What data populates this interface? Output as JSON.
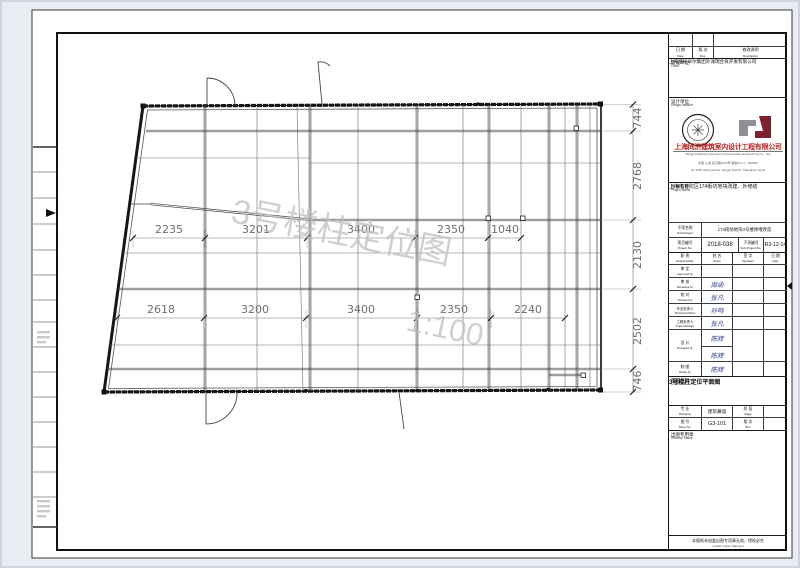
{
  "watermark": {
    "title": "3号楼柱定位图",
    "scale": "1:100"
  },
  "plan": {
    "dims_mid": [
      "2235",
      "3201",
      "3400",
      "2350",
      "1040"
    ],
    "dims_bottom": [
      "2618",
      "3200",
      "3400",
      "2350",
      "2240"
    ],
    "dims_right": [
      "744",
      "2768",
      "2130",
      "2502",
      "746"
    ]
  },
  "titleblock": {
    "revision": {
      "date_cn": "日 期",
      "date_en": "Date",
      "rev_cn": "版 次",
      "rev_en": "Rev.",
      "desc_cn": "修改说明",
      "desc_en": "Description"
    },
    "client": {
      "label_cn": "建设单位",
      "label_en": "Client",
      "name": "上海临光卓尔集团外滩瑞合资开发有限公司"
    },
    "design_institute": {
      "label_cn": "设计单位",
      "label_en": "Design Institute",
      "company_cn": "上海同济建筑室内设计工程有限公司",
      "company_en": "Tongji Architectural Design and Decoration Engineering Co., Ltd.",
      "address": "中国 上海 四平路1230号  邮编(P.C.)：200092",
      "address2": "No.1230 Siping Road, Yangpu District, Shanghai, China"
    },
    "project": {
      "label_cn": "项目名称",
      "label_en": "Project Name",
      "name": "上海市普陀区174街坊地块改建、外修缮"
    },
    "sub_project": {
      "label_cn": "子项名称",
      "label_en": "Sub-Project",
      "name": "174街坊地块3号楼修缮改造"
    },
    "project_no": {
      "label_cn": "项目编号",
      "label_en": "Project No.",
      "value": "2018-038"
    },
    "sub_project_no": {
      "label_cn": "子项编号",
      "label_en": "Sub-Project No.",
      "value": "R3-12-14"
    },
    "sign_table": {
      "headers": [
        {
          "cn": "职  责",
          "en": "Responsibility"
        },
        {
          "cn": "姓  名",
          "en": "Name"
        },
        {
          "cn": "签  字",
          "en": "Signature"
        },
        {
          "cn": "日  期",
          "en": "Date"
        }
      ],
      "rows": [
        {
          "role_cn": "审  定",
          "role_en": "Approved by",
          "name": ""
        },
        {
          "role_cn": "审  核",
          "role_en": "Reviewed by",
          "name": "周函"
        },
        {
          "role_cn": "校  对",
          "role_en": "Checked by",
          "name": "张凡"
        },
        {
          "role_cn": "专业负责人",
          "role_en": "Principal Architect",
          "name": "孙鸣"
        },
        {
          "role_cn": "工程负责人",
          "role_en": "Project Manager",
          "name": "张凡"
        },
        {
          "role_cn": "设  计",
          "role_en": "Designed by",
          "name": "陈辉"
        },
        {
          "role_cn": "制  图",
          "role_en": "Drawn by",
          "name": "陈辉"
        }
      ],
      "design_name2": "陈辉"
    },
    "chart_title": {
      "label_cn": "图纸名称",
      "label_en": "Chart Title",
      "value": "3号楼柱定位平面图"
    },
    "discipline": {
      "label_cn": "专  业",
      "label_en": "Discipline",
      "value": "建筑幕墙"
    },
    "stage": {
      "label_cn": "阶  段",
      "label_en": "Stage",
      "value": ""
    },
    "sheet_no": {
      "label_cn": "图  号",
      "label_en": "Sheet No.",
      "value": "G3-101"
    },
    "rev2": {
      "label_cn": "版  次",
      "label_en": "Rev.",
      "value": ""
    },
    "stamp": {
      "label_cn": "出图专用章",
      "label_en": "Release Stamp"
    },
    "footer": {
      "cn": "本图纸未加盖出图专用章无效，侵权必究",
      "en": "Invalid Unless Stamped"
    }
  }
}
